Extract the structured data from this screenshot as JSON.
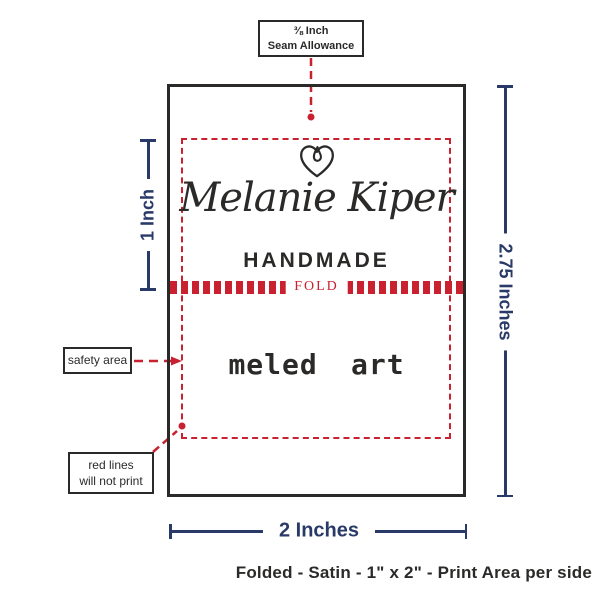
{
  "callouts": {
    "seam": {
      "line1": "⅜ Inch",
      "line2": "Seam Allowance"
    },
    "safety": {
      "label": "safety area"
    },
    "red_lines": {
      "line1": "red lines",
      "line2": "will not print"
    }
  },
  "label": {
    "brand_name": "Melanie Kiper",
    "brand_subtitle": "HANDMADE",
    "fold": "FOLD",
    "back_text": "meled art"
  },
  "dimensions": {
    "print_height": "1 Inch",
    "total_height": "2.75 Inches",
    "width": "2 Inches"
  },
  "caption": "Folded - Satin - 1\" x 2\" - Print Area per side",
  "colors": {
    "guide_red": "#c9212f",
    "dimension_navy": "#2a3a68",
    "ink": "#2b2a29"
  }
}
